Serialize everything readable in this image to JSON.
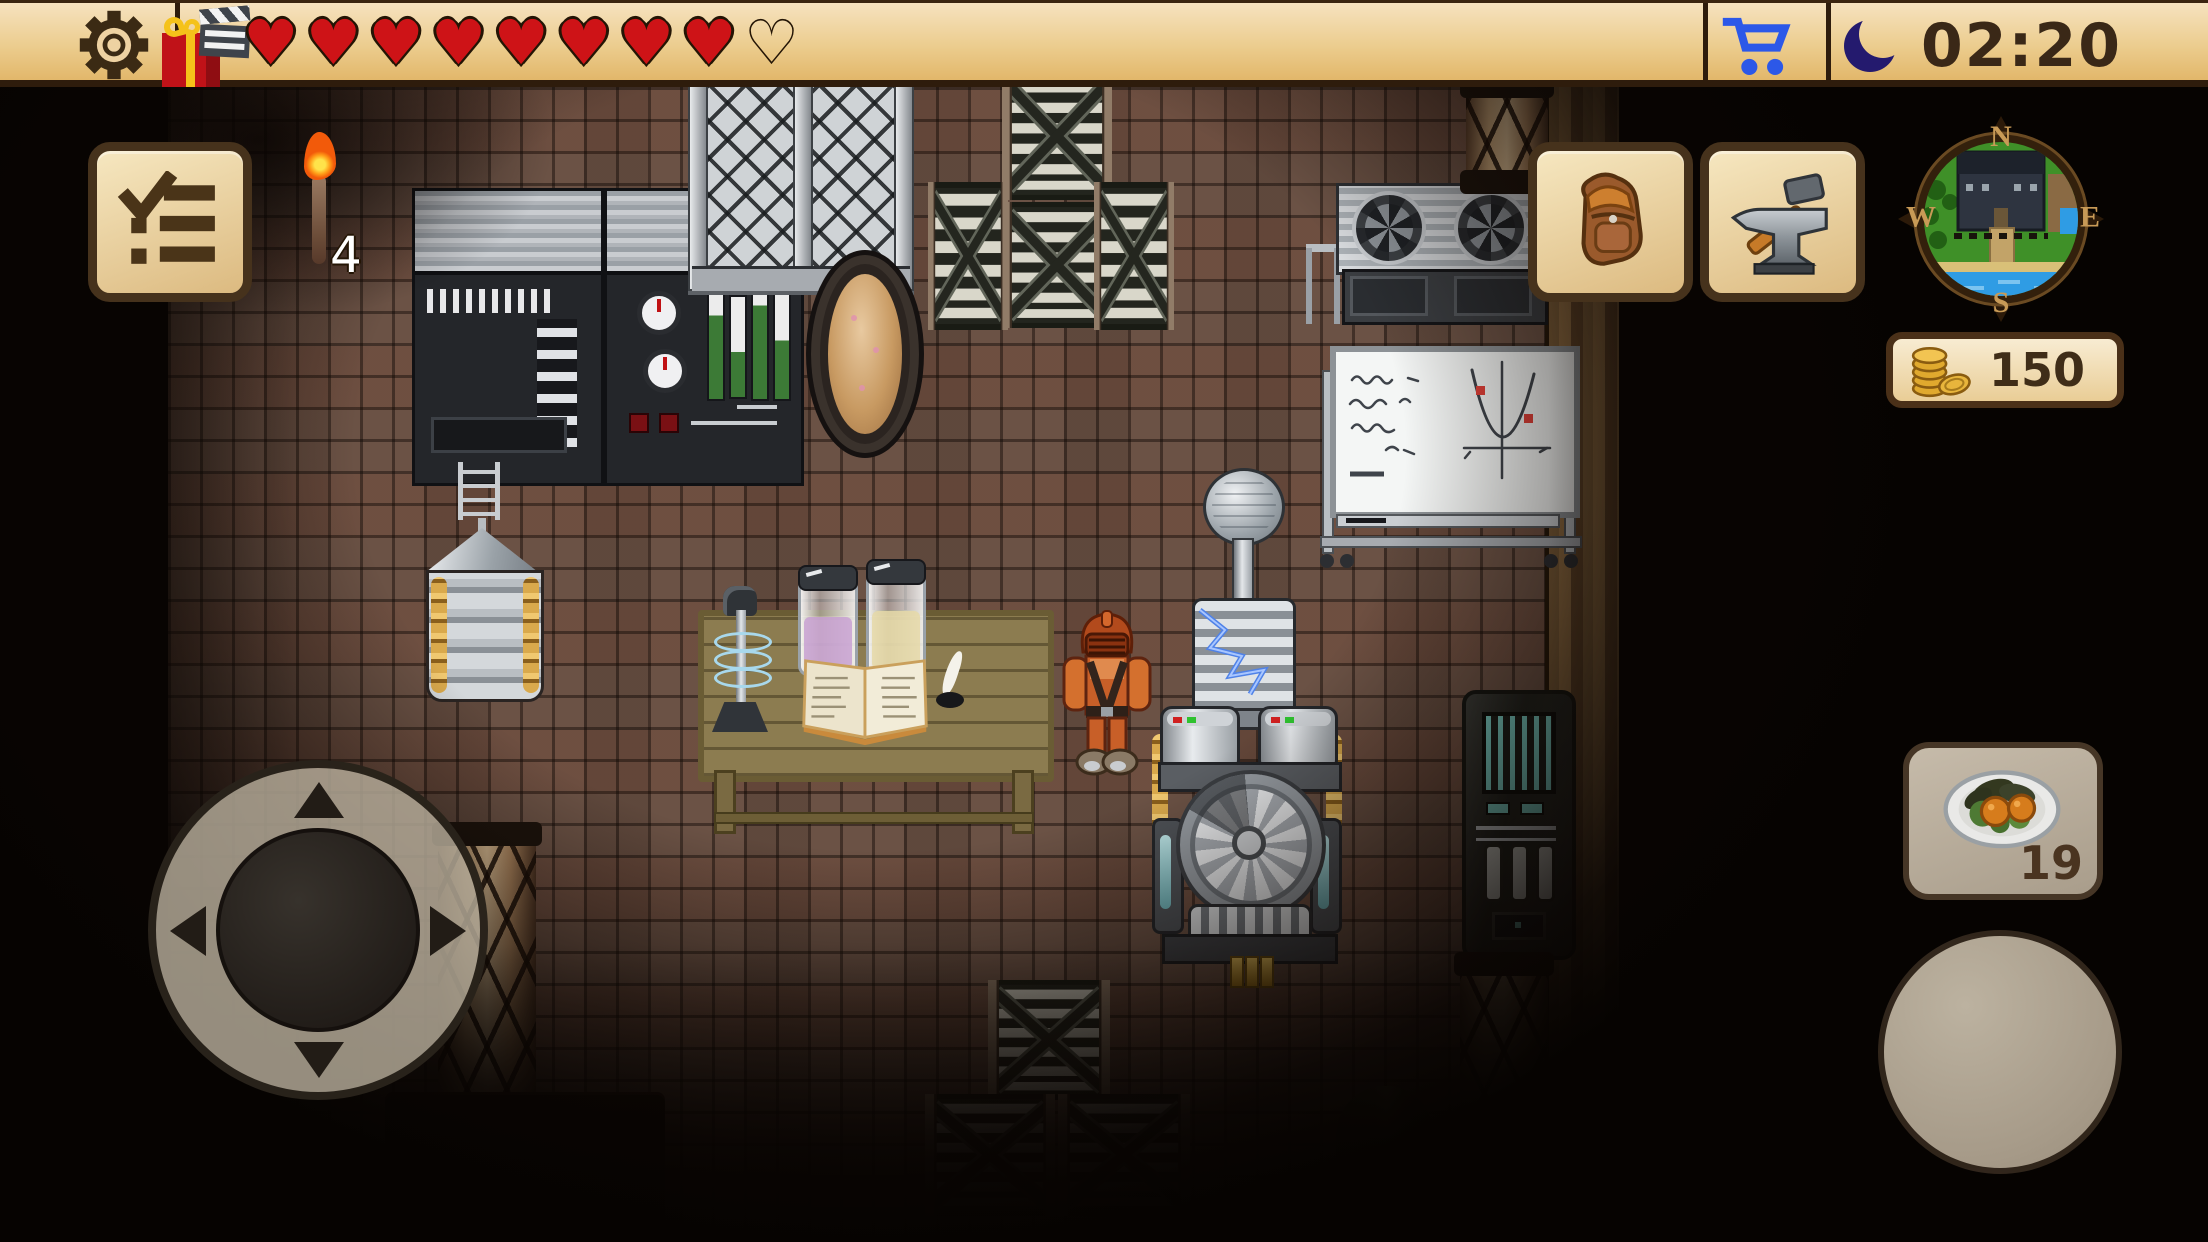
{
  "hud": {
    "top_bar": {
      "settings_button": {
        "icon": "gear-icon"
      },
      "gift_button": {
        "icon": "gift-icon",
        "badge_icon": "clapperboard-icon"
      },
      "health": {
        "filled": 8,
        "empty": 1,
        "filled_glyph": "♥",
        "empty_glyph": "♡"
      },
      "shop_button": {
        "icon": "cart-icon"
      },
      "clock": {
        "icon": "moon-icon",
        "time": "02:20"
      }
    },
    "left_panel": {
      "quest_button": {
        "icon": "checklist-icon"
      },
      "torch": {
        "icon": "torch-icon",
        "count": "4"
      }
    },
    "right_panel": {
      "inventory_button": {
        "icon": "backpack-icon"
      },
      "crafting_button": {
        "icon": "anvil-hammer-icon"
      },
      "minimap": {
        "labels": {
          "north": "N",
          "west": "W",
          "south": "S",
          "east": "E"
        }
      },
      "coins": {
        "icon": "coin-stack-icon",
        "value": "150"
      },
      "food_slot": {
        "icon": "salad-plate-icon",
        "count": "19"
      }
    },
    "controls": {
      "dpad": {
        "icon": "dpad-icon"
      },
      "action_button": {}
    }
  },
  "palette": {
    "hud_tan": "#eccd8f",
    "hud_border": "#2e1c0c",
    "button_face": "#f1e0b4",
    "button_border": "#46321c",
    "heart_red": "#ce1317",
    "cart_blue": "#2c58e8",
    "moon_indigo": "#241a6e",
    "text_brown": "#3a2817",
    "coin_gold": "#e2ac34",
    "floor_brown": "#6b5245"
  },
  "scene": {
    "setting": "pixel-art steampunk laboratory interior at night, dark vignette",
    "objects": [
      "control-console",
      "security-gate",
      "oval-mirror",
      "stacked-crates",
      "ventilation-fan-unit",
      "whiteboard-with-equations",
      "storage-silo",
      "ladder-antenna",
      "wooden-table",
      "tesla-coil-lamp",
      "glass-jars",
      "open-book",
      "quill-and-ink",
      "player-character",
      "tesla-coil-machine",
      "generator-machine",
      "server-cabinet",
      "rope-pillars",
      "moss-sack",
      "brick-floor",
      "wood-wall"
    ]
  }
}
